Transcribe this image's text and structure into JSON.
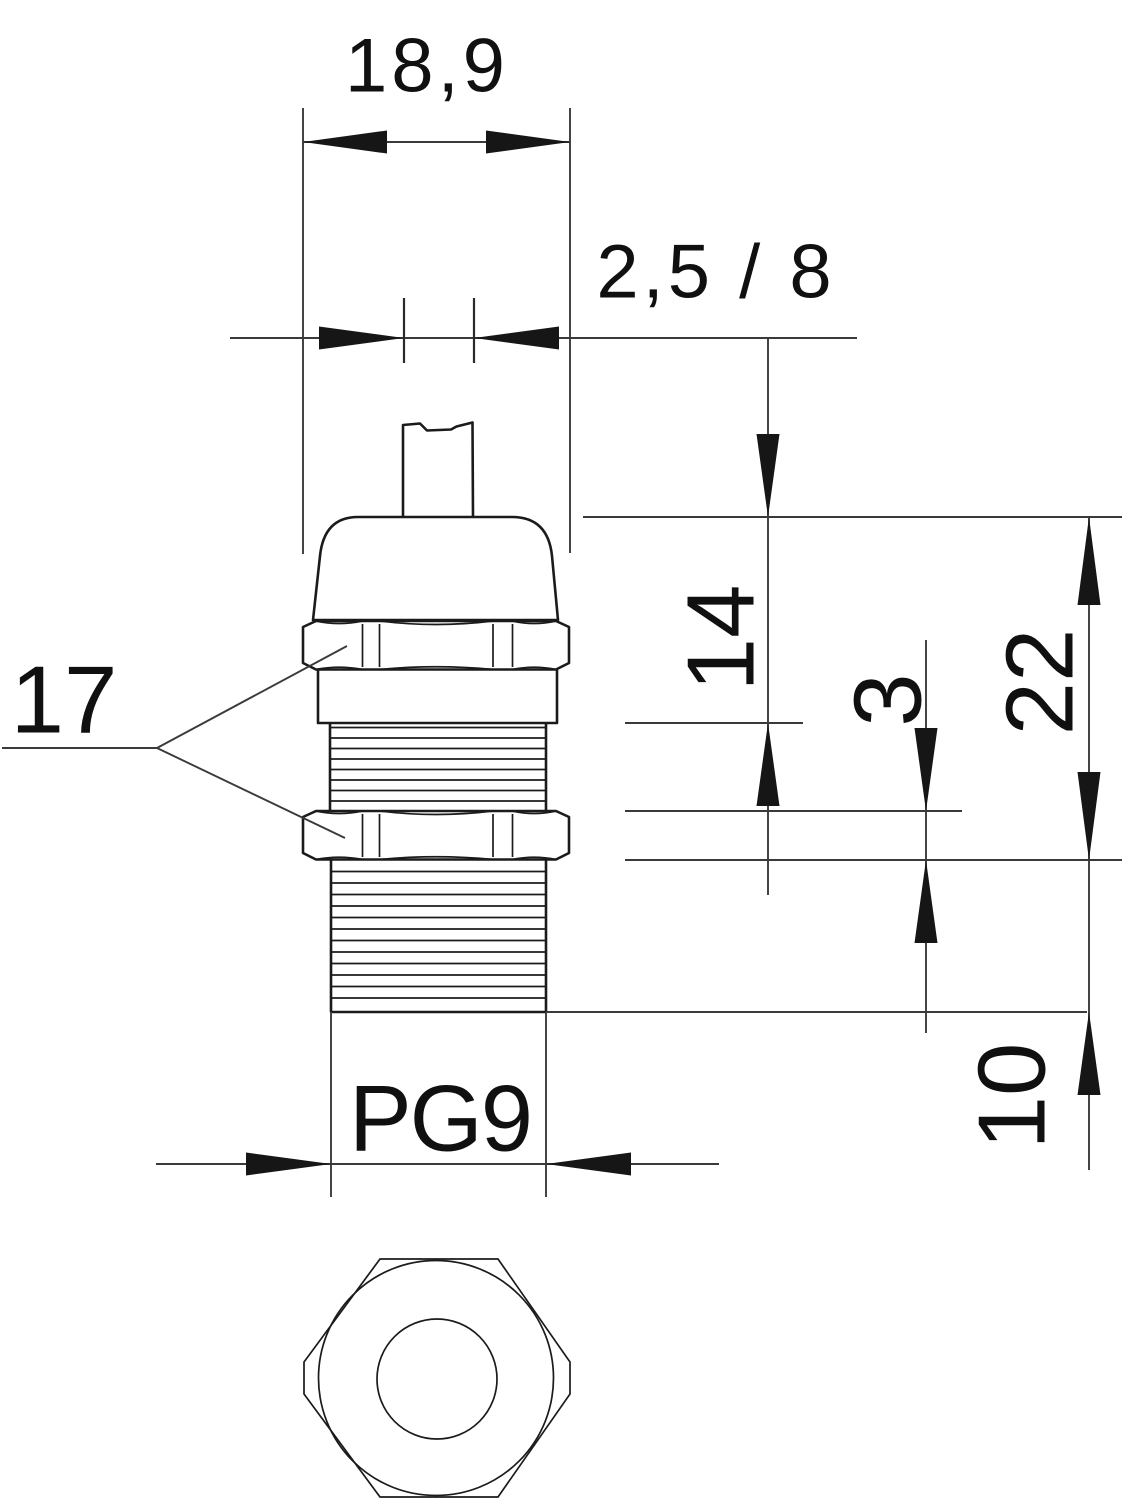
{
  "labels": {
    "overall_width": "18,9",
    "clamping_range": "2,5 / 8",
    "height_cap": "14",
    "locknut_thickness": "3",
    "overall_height": "22",
    "thread_length": "10",
    "wrench_size": "17",
    "thread_size": "PG9"
  },
  "colors": {
    "background": "#ffffff",
    "part_outline": "#1b1b1b",
    "dimension_lines": "#3a3a3a",
    "arrowheads": "#161616",
    "text": "#101010"
  }
}
